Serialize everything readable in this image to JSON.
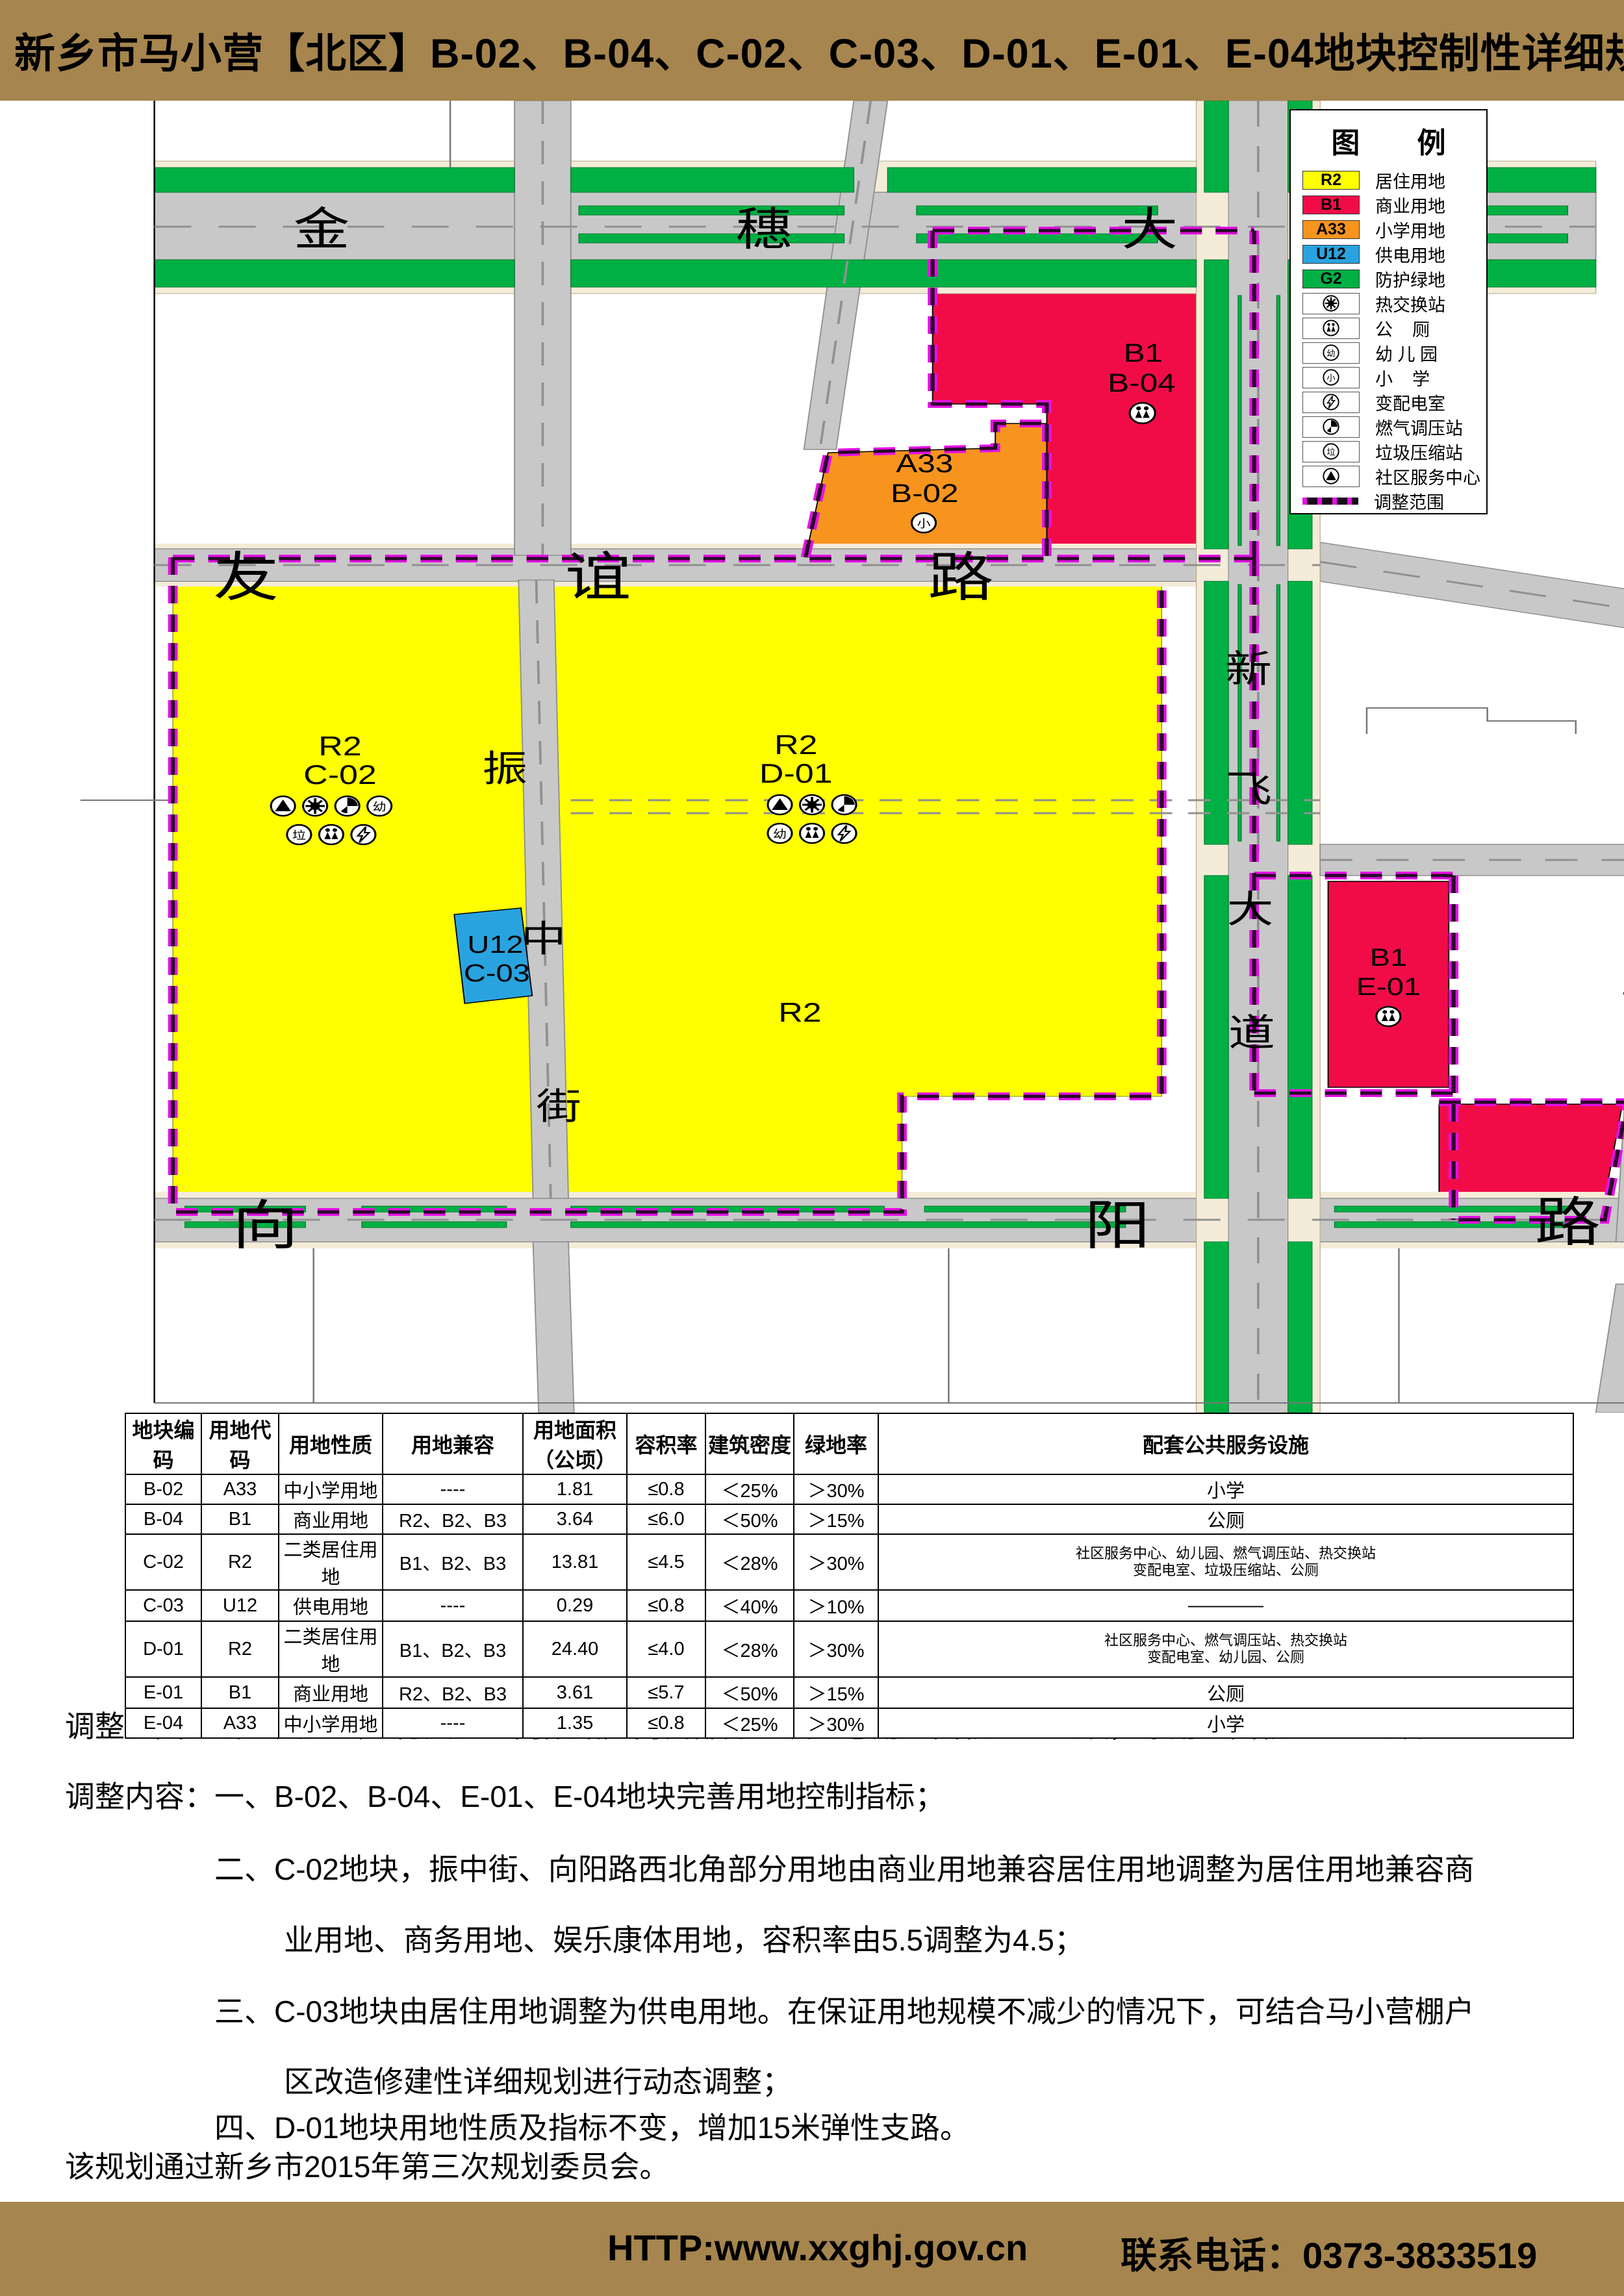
{
  "title": "新乡市马小营【北区】B-02、B-04、C-02、C-03、D-01、E-01、E-04地块控制性详细规划调整",
  "colors": {
    "banner_gold": "#A6854E",
    "residential_yellow": "#FFFF00",
    "commercial_red": "#F10C48",
    "school_orange": "#F7941E",
    "power_blue": "#29A3DF",
    "green_belt": "#00B044",
    "road_gray": "#C8C8C8",
    "adjust_magenta": "#E511E5"
  },
  "icons": {
    "kindergarten_glyph": "幼",
    "school_glyph": "小",
    "garbage_glyph": "垃"
  },
  "legend": {
    "title": "图  例",
    "items": [
      {
        "code": "R2",
        "label": "居住用地",
        "color": "#FFFF00"
      },
      {
        "code": "B1",
        "label": "商业用地",
        "color": "#F10C48"
      },
      {
        "code": "A33",
        "label": "小学用地",
        "color": "#F7941E"
      },
      {
        "code": "U12",
        "label": "供电用地",
        "color": "#29A3DF"
      },
      {
        "code": "G2",
        "label": "防护绿地",
        "color": "#00B044"
      },
      {
        "icon": "heat-exchange-icon",
        "label": "热交换站"
      },
      {
        "icon": "public-toilet-icon",
        "label": "公    厕"
      },
      {
        "icon": "kindergarten-icon",
        "label": "幼 儿 园"
      },
      {
        "icon": "primary-school-icon",
        "label": "小    学"
      },
      {
        "icon": "power-room-icon",
        "label": "变配电室"
      },
      {
        "icon": "gas-regulator-icon",
        "label": "燃气调压站"
      },
      {
        "icon": "garbage-compress-icon",
        "label": "垃圾压缩站"
      },
      {
        "icon": "community-center-icon",
        "label": "社区服务中心"
      },
      {
        "icon": "adjust-range-dash",
        "label": "调整范围"
      }
    ]
  },
  "map": {
    "roads": {
      "jinsui": [
        "金",
        "穗",
        "大",
        "道"
      ],
      "youyi": [
        "友",
        "谊",
        "路"
      ],
      "xiangyang": [
        "向",
        "阳",
        "路"
      ],
      "xinfei": [
        "新",
        "飞",
        "大",
        "道"
      ],
      "zhenzhong": [
        "振",
        "中",
        "街"
      ],
      "guihua": [
        "规",
        "划",
        "路"
      ]
    },
    "parcels": {
      "b02": {
        "code": "A33",
        "id": "B-02"
      },
      "b04": {
        "code": "B1",
        "id": "B-04"
      },
      "c02": {
        "code": "R2",
        "id": "C-02"
      },
      "c03": {
        "code": "U12",
        "id": "C-03"
      },
      "d01": {
        "code": "R2",
        "id": "D-01"
      },
      "d01_south": {
        "code": "R2"
      },
      "e01": {
        "code": "B1",
        "id": "E-01"
      },
      "e04": {
        "code": "A33",
        "id": "E-04"
      }
    }
  },
  "table": {
    "headers": [
      "地块编码",
      "用地代码",
      "用地性质",
      "用地兼容",
      "用地面积",
      "（公顷）",
      "容积率",
      "建筑密度",
      "绿地率",
      "配套公共服务设施"
    ],
    "rows": [
      {
        "id": "B-02",
        "code": "A33",
        "nature": "中小学用地",
        "compat": "----",
        "area": "1.81",
        "far": "≤0.8",
        "density": "＜25%",
        "green": "＞30%",
        "services": [
          "小学"
        ]
      },
      {
        "id": "B-04",
        "code": "B1",
        "nature": "商业用地",
        "compat": "R2、B2、B3",
        "area": "3.64",
        "far": "≤6.0",
        "density": "＜50%",
        "green": "＞15%",
        "services": [
          "公厕"
        ]
      },
      {
        "id": "C-02",
        "code": "R2",
        "nature": "二类居住用地",
        "compat": "B1、B2、B3",
        "area": "13.81",
        "far": "≤4.5",
        "density": "＜28%",
        "green": "＞30%",
        "services": [
          "社区服务中心、幼儿园、燃气调压站、热交换站",
          "变配电室、垃圾压缩站、公厕"
        ]
      },
      {
        "id": "C-03",
        "code": "U12",
        "nature": "供电用地",
        "compat": "----",
        "area": "0.29",
        "far": "≤0.8",
        "density": "＜40%",
        "green": "＞10%",
        "services": [
          "————"
        ]
      },
      {
        "id": "D-01",
        "code": "R2",
        "nature": "二类居住用地",
        "compat": "B1、B2、B3",
        "area": "24.40",
        "far": "≤4.0",
        "density": "＜28%",
        "green": "＞30%",
        "services": [
          "社区服务中心、燃气调压站、热交换站",
          "变配电室、幼儿园、公厕"
        ]
      },
      {
        "id": "E-01",
        "code": "B1",
        "nature": "商业用地",
        "compat": "R2、B2、B3",
        "area": "3.61",
        "far": "≤5.7",
        "density": "＜50%",
        "green": "＞15%",
        "services": [
          "公厕"
        ]
      },
      {
        "id": "E-04",
        "code": "A33",
        "nature": "中小学用地",
        "compat": "----",
        "area": "1.35",
        "far": "≤0.8",
        "density": "＜25%",
        "green": "＞30%",
        "services": [
          "小学"
        ]
      }
    ]
  },
  "notes": {
    "line1": "调整范围：新飞大道（金穗大道—向阳路）两侧部分地块。总用地面积56.8公顷，净用地面积48.91公顷。",
    "line2": "调整内容：一、B-02、B-04、E-01、E-04地块完善用地控制指标；",
    "line3": "二、C-02地块，振中街、向阳路西北角部分用地由商业用地兼容居住用地调整为居住用地兼容商",
    "line4": "业用地、商务用地、娱乐康体用地，容积率由5.5调整为4.5；",
    "line5": "三、C-03地块由居住用地调整为供电用地。在保证用地规模不减少的情况下，可结合马小营棚户",
    "line6": "区改造修建性详细规划进行动态调整；",
    "line7": "四、D-01地块用地性质及指标不变，增加15米弹性支路。",
    "line8": "该规划通过新乡市2015年第三次规划委员会。"
  },
  "footer": {
    "url": "HTTP:www.xxghj.gov.cn",
    "phone": "联系电话：0373-3833519"
  }
}
